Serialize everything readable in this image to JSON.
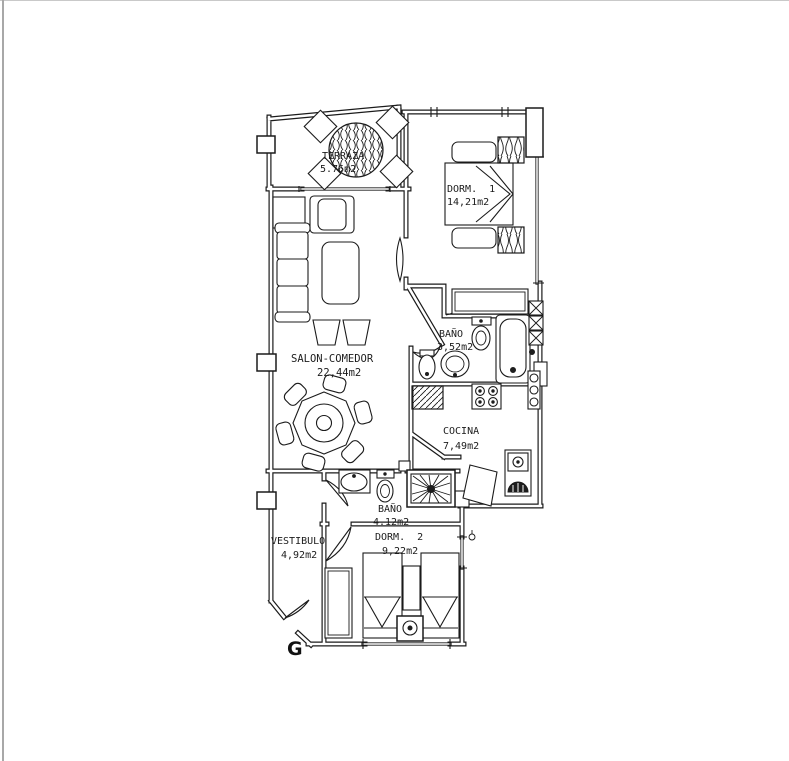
{
  "page": {
    "background": "#ffffff",
    "edge_line_color": "#a8a8a8"
  },
  "floorplan": {
    "line_color": "#1b1b1b",
    "type": "apartment-floor-plan",
    "rooms": {
      "terraza": {
        "label": "TERRAZA",
        "area": "5.76m2"
      },
      "dorm1": {
        "label": "DORM.  1",
        "area": "14,21m2"
      },
      "salon": {
        "label": "SALON-COMEDOR",
        "area": "22,44m2"
      },
      "bano1": {
        "label": "BAÑO",
        "area": "3,52m2"
      },
      "cocina": {
        "label": "COCINA",
        "area": "7,49m2"
      },
      "bano2": {
        "label": "BAÑO",
        "area": "4.12m2"
      },
      "vestibulo": {
        "label": "VESTIBULO",
        "area": "4,92m2"
      },
      "dorm2": {
        "label": "DORM.  2",
        "area": "9,22m2"
      }
    },
    "entrance_label": "G"
  }
}
